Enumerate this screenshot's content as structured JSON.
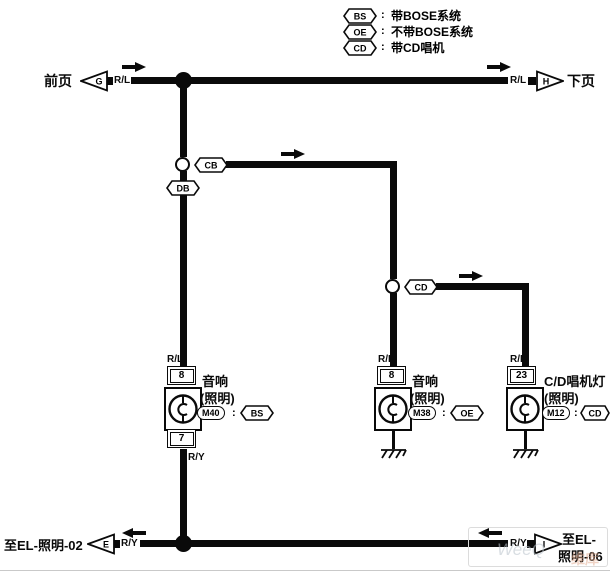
{
  "legend": {
    "rows": [
      {
        "tag": "BS",
        "colon": ":",
        "text": "带BOSE系统"
      },
      {
        "tag": "OE",
        "colon": ":",
        "text": "不带BOSE系统"
      },
      {
        "tag": "CD",
        "colon": ":",
        "text": "带CD唱机"
      }
    ]
  },
  "top": {
    "prev_label": "前页",
    "prev_letter": "G",
    "wire_left": "R/L",
    "wire_right": "R/L",
    "next_letter": "H",
    "next_label": "下页"
  },
  "bottom": {
    "dest_left": "至EL-照明-02",
    "left_letter": "E",
    "wire_left": "R/Y",
    "wire_right": "R/Y",
    "right_letter": "I",
    "dest_right_line1": "至EL-",
    "dest_right_line2": "照明-06"
  },
  "splices": {
    "cb": "CB",
    "db": "DB",
    "cd": "CD"
  },
  "components": {
    "m40": {
      "wire_in": "R/L",
      "pin_in": "8",
      "name": "音响",
      "sub": "(照明)",
      "code": "M40",
      "colon": ":",
      "cond": "BS",
      "pin_out": "7",
      "wire_out": "R/Y"
    },
    "m38": {
      "wire_in": "R/L",
      "pin_in": "8",
      "name": "音响",
      "sub": "(照明)",
      "code": "M38",
      "colon": ":",
      "cond": "OE"
    },
    "m12": {
      "wire_in": "R/L",
      "pin_in": "23",
      "name": "C/D唱机灯",
      "sub": "(照明)",
      "code": "M12",
      "colon": ":",
      "cond": "CD"
    }
  },
  "colors": {
    "wire": "#0a0a0a",
    "background": "#ffffff",
    "watermark_gray": "#b9c3cb",
    "watermark_orange": "#e2a98c"
  },
  "watermark": {
    "part1": "WeeQ",
    "part2": "维库"
  }
}
